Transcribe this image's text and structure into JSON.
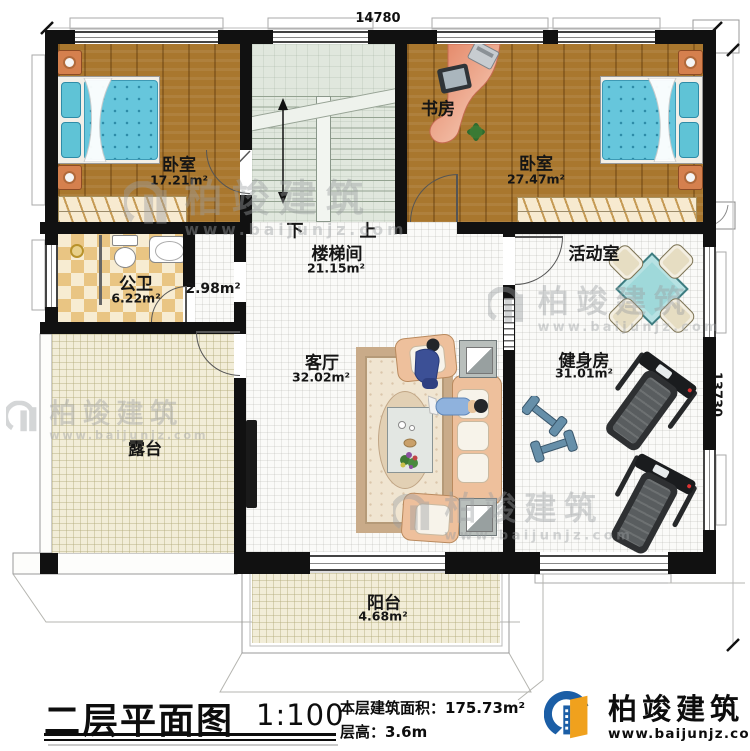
{
  "dimensions": {
    "top": "14780",
    "right": "13730"
  },
  "stairs": {
    "down_label": "下",
    "up_label": "上"
  },
  "rooms": {
    "bedroom1": {
      "name": "卧室",
      "area": "17.21m²"
    },
    "study": {
      "name": "书房"
    },
    "bedroom2": {
      "name": "卧室",
      "area": "27.47m²"
    },
    "bathroom": {
      "name": "公卫",
      "area": "6.22m²"
    },
    "closet": {
      "area": "2.98m²"
    },
    "stairwell": {
      "name": "楼梯间",
      "area": "21.15m²"
    },
    "activity_room": {
      "name": "活动室"
    },
    "living_room": {
      "name": "客厅",
      "area": "32.02m²"
    },
    "gym": {
      "name": "健身房",
      "area": "31.01m²"
    },
    "terrace": {
      "name": "露台"
    },
    "balcony": {
      "name": "阳台",
      "area": "4.68m²"
    }
  },
  "title_block": {
    "title": "二层平面图",
    "scale": "1:100",
    "floor_area_label": "本层建筑面积：175.73m²",
    "floor_height_label": "层高：3.6m"
  },
  "brand": {
    "name": "柏竣建筑",
    "website": "www.baijunjz.com"
  },
  "watermark": {
    "name": "柏竣建筑",
    "website": "www.baijunjz.com"
  },
  "colors": {
    "wall": "#111111",
    "wood_floor": "#a9772e",
    "stair_floor": "#e0e7dd",
    "bath_tile": "#e9c583",
    "terrace_tile": "#f2edd8",
    "bed": "#66c6dc",
    "sofa": "#eec09c",
    "game_table": "#9fd9da",
    "brand_blue": "#1b5ea6",
    "brand_orange": "#f0a11d"
  }
}
